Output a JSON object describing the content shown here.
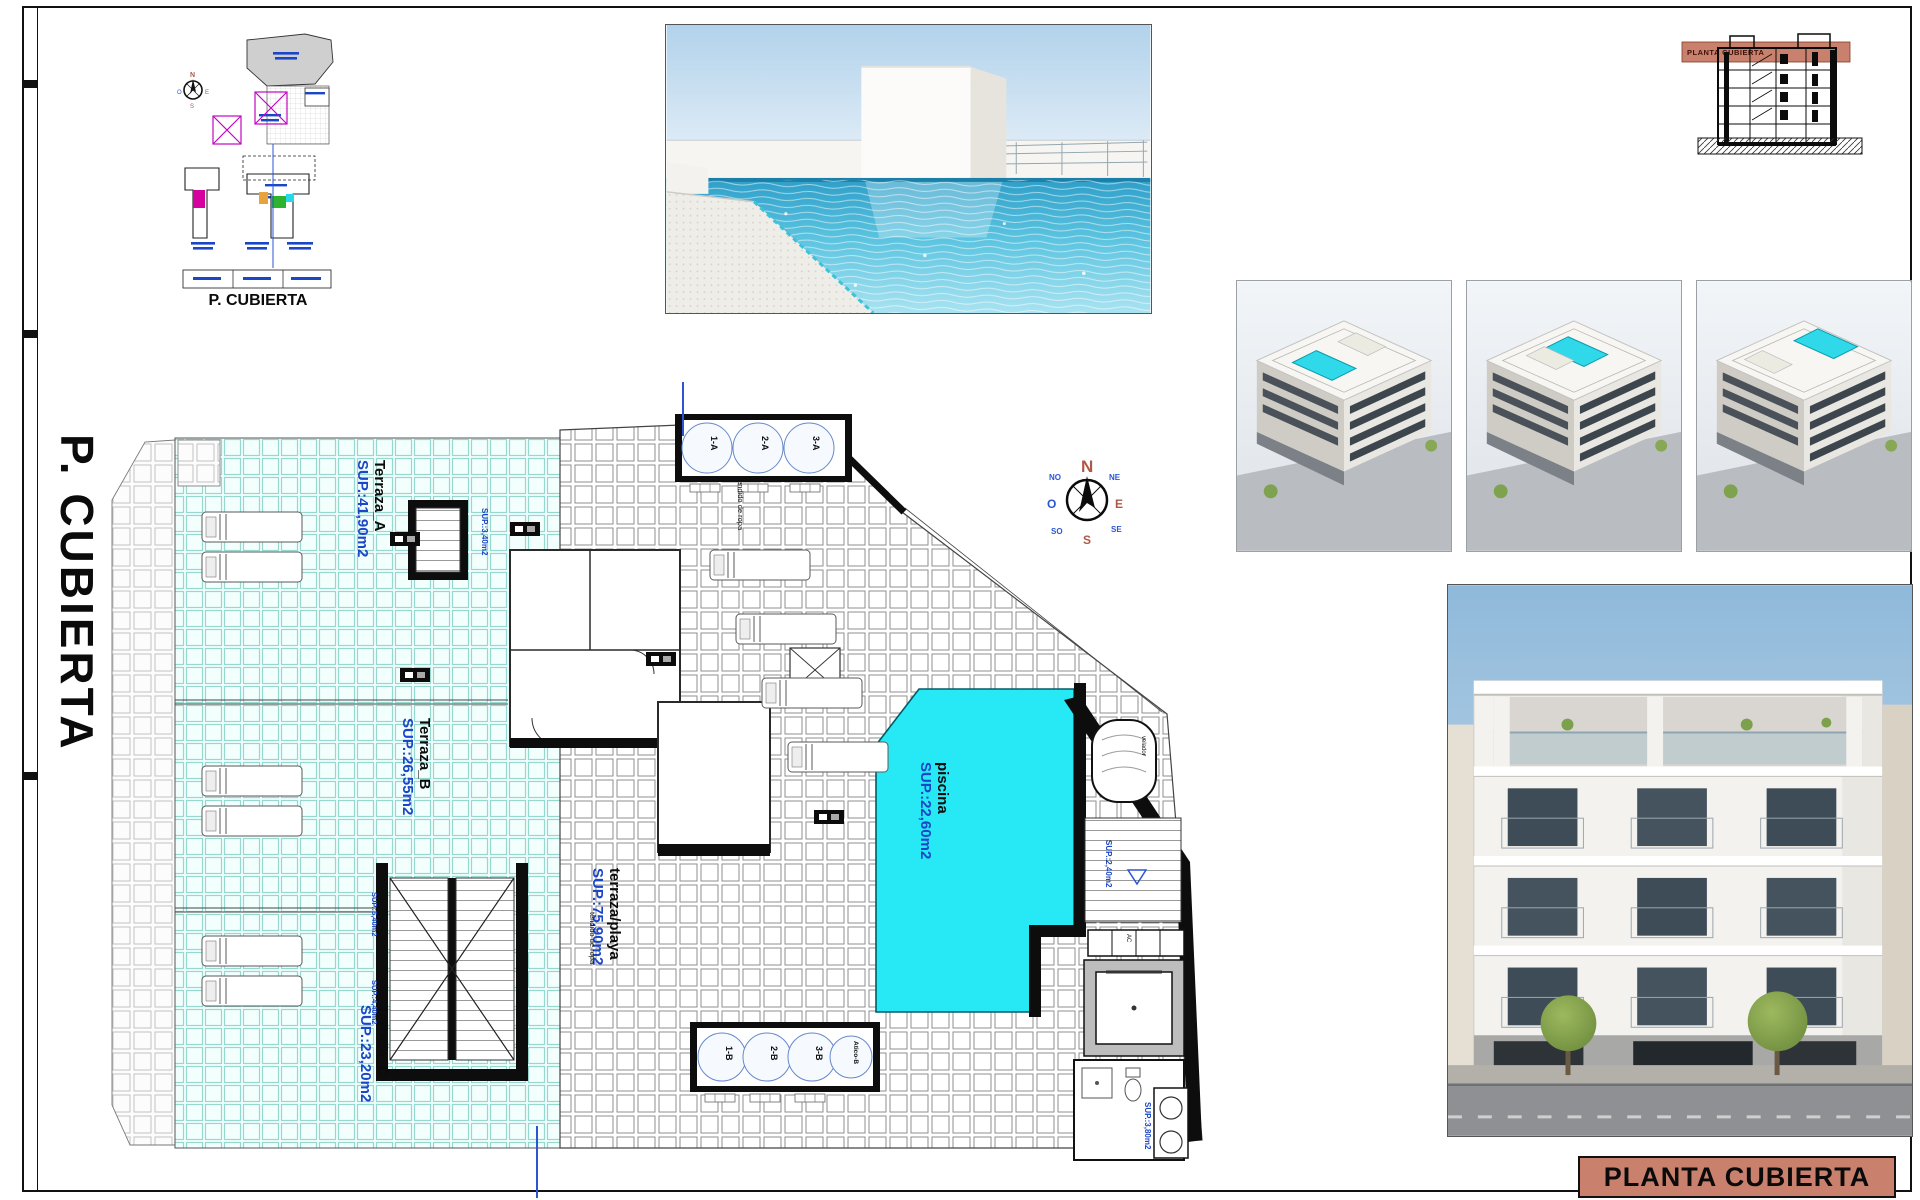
{
  "sheet": {
    "side_title": "P. CUBIERTA",
    "title_block_label": "PLANTA CUBIERTA"
  },
  "site_plan": {
    "caption": "P. CUBIERTA"
  },
  "section_thumb": {
    "band_label": "PLANTA CUBIERTA"
  },
  "plan": {
    "areas": {
      "terraza_a": {
        "name": "Terraza_A",
        "sup": "SUP.:41,90m2"
      },
      "terraza_b": {
        "name": "Terraza_B",
        "sup": "SUP.:26,55m2"
      },
      "terraza_c": {
        "name": "Terraza_C",
        "sup": "SUP.:23,20m2"
      },
      "playa": {
        "name": "terraza/playa",
        "sup": "SUP.:75,90m2"
      },
      "piscina": {
        "name": "piscina",
        "sup": "SUP.:22,60m2"
      },
      "bano": {
        "name": "BAÑO.2",
        "sup": "SUP.:3,80m2"
      },
      "stair_top": {
        "sup": "SUP.:3,40m2"
      },
      "stair_mid_1": {
        "sup": "SUP.:5,40m2"
      },
      "stair_mid_2": {
        "sup": "SUP.:4,40m2"
      },
      "stair_right": {
        "sup": "SUP.:2,40m2"
      },
      "tendido": "tendido de ropa",
      "velador": "velador",
      "ac": "AC"
    },
    "skylights_top": [
      "1-A",
      "2-A",
      "3-A"
    ],
    "skylights_bottom": [
      "1-B",
      "2-B",
      "3-B",
      "Atico-B"
    ],
    "compass": {
      "n": "N",
      "s": "S",
      "e": "E",
      "o": "O",
      "ne": "NE",
      "se": "SE",
      "so": "SO",
      "no": "NO"
    }
  },
  "colors": {
    "salmon_band": "#c9806c",
    "pool_cyan": "#27e8f5",
    "label_blue": "#1a46c8",
    "tile_teal": "#96d8d0"
  }
}
